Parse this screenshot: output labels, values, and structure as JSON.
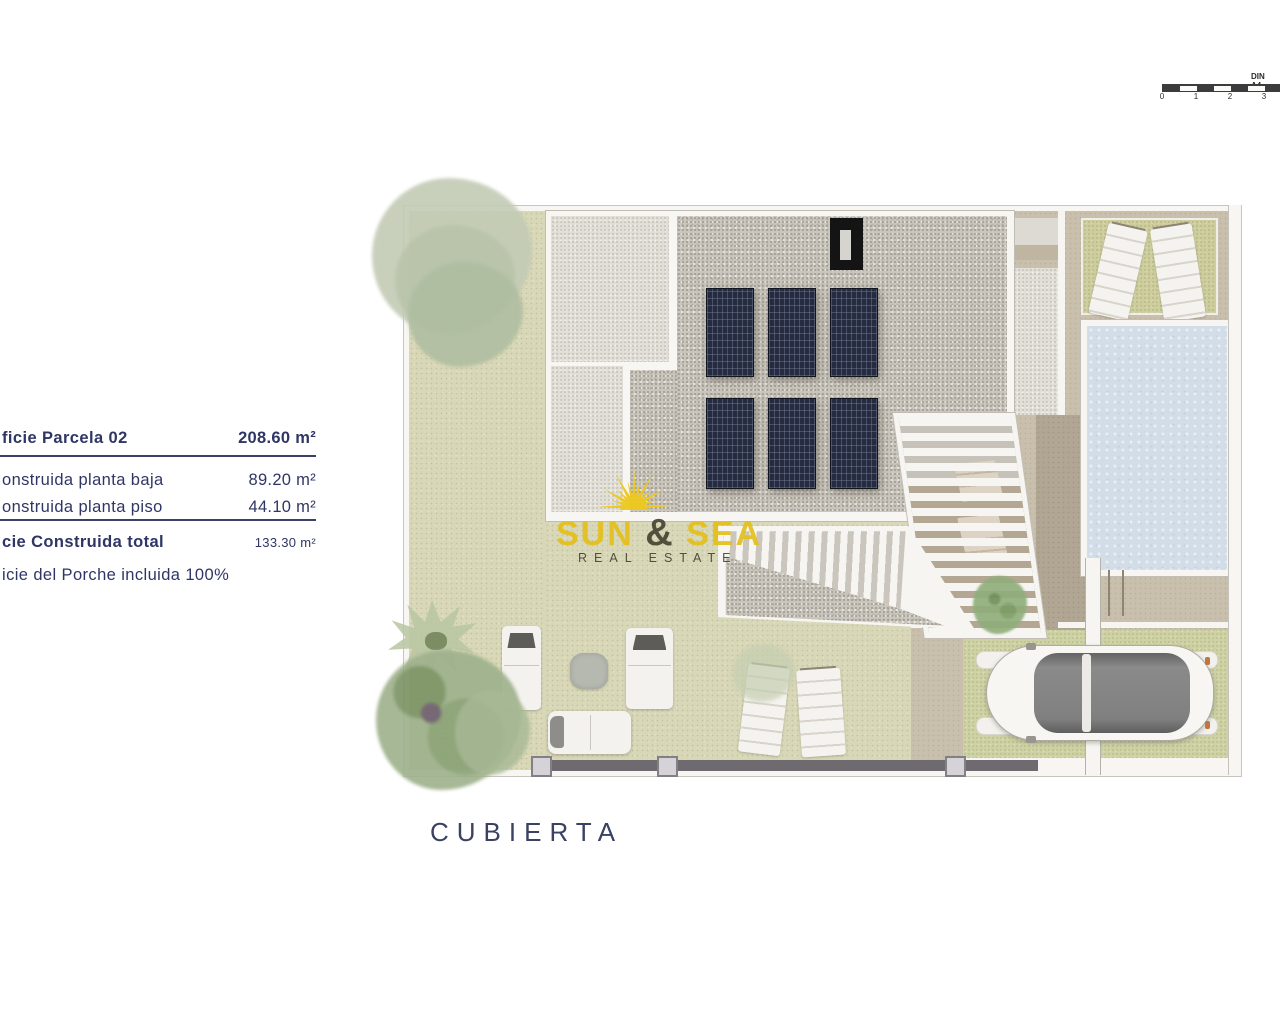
{
  "area_table": {
    "rows": [
      {
        "label": "ficie Parcela 02",
        "value": "208.60 m²"
      },
      {
        "label": "onstruida planta baja",
        "value": "89.20 m²"
      },
      {
        "label": "onstruida planta piso",
        "value": "44.10 m²"
      },
      {
        "label": "cie Construida total",
        "value": "133.30 m²"
      },
      {
        "label": "icie del Porche incluida 100%",
        "value": ""
      }
    ]
  },
  "caption": "CUBIERTA",
  "scalebar": {
    "label": "DIN A4",
    "ticks": [
      "0",
      "1",
      "2",
      "3"
    ]
  },
  "watermark": {
    "word_sun": "SUN",
    "amp": "&",
    "word_sea": "SEA",
    "subtitle": "REAL ESTATE"
  },
  "colors": {
    "accent_yellow": "#e4c01c",
    "text_navy": "#2f3665",
    "solar_panel_navy": "#262c40",
    "pool_blue": "#d2dde8",
    "grass_green": "#d8d7b7",
    "gravel_gray": "#cac6bd",
    "terrace_beige": "#c9bfad"
  }
}
